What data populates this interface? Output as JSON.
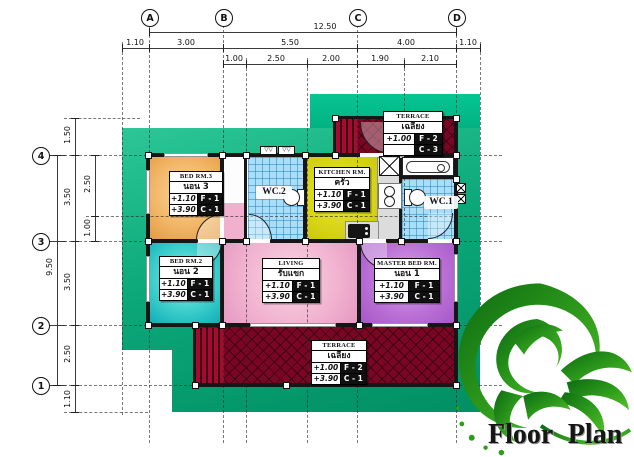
{
  "title": "Floor Plan",
  "grid": {
    "columns": [
      "A",
      "B",
      "C",
      "D"
    ],
    "rows": [
      "4",
      "3",
      "2",
      "1"
    ]
  },
  "dims": {
    "overall_width": "12.50",
    "overall_height": "9.50",
    "top_row1": [
      "1.10",
      "3.00",
      "5.50",
      "4.00",
      "1.10"
    ],
    "top_row2": [
      "1.00",
      "2.50",
      "2.00",
      "1.90",
      "2.10"
    ],
    "left_col1": [
      "1.50",
      "3.50",
      "3.50",
      "2.50",
      "1.10"
    ],
    "left_col2": [
      "2.50",
      "1.00"
    ]
  },
  "rooms": {
    "bed3": {
      "name_en": "BED RM.3",
      "name_th": "นอน 3",
      "floor_level": "+1.10",
      "floor_code": "F - 1",
      "ceiling_level": "+3.90",
      "ceiling_code": "C - 1"
    },
    "bed2": {
      "name_en": "BED RM.2",
      "name_th": "นอน 2",
      "floor_level": "+1.10",
      "floor_code": "F - 1",
      "ceiling_level": "+3.90",
      "ceiling_code": "C - 1"
    },
    "master": {
      "name_en": "MASTER BED RM.",
      "name_th": "นอน 1",
      "floor_level": "+1.10",
      "floor_code": "F - 1",
      "ceiling_level": "+3.90",
      "ceiling_code": "C - 1"
    },
    "living": {
      "name_en": "LIVING",
      "name_th": "รับแขก",
      "floor_level": "+1.10",
      "floor_code": "F - 1",
      "ceiling_level": "+3.90",
      "ceiling_code": "C - 1"
    },
    "kitchen": {
      "name_en": "KITCHEN RM.",
      "name_th": "ครัว",
      "floor_level": "+1.10",
      "floor_code": "F - 1",
      "ceiling_level": "+3.90",
      "ceiling_code": "C - 1"
    },
    "terrace_top": {
      "name_en": "TERRACE",
      "name_th": "เฉลียง",
      "floor_level": "+1.00",
      "floor_code": "F - 2",
      "ceiling_level": "",
      "ceiling_code": "C - 3"
    },
    "terrace_bottom": {
      "name_en": "TERRACE",
      "name_th": "เฉลียง",
      "floor_level": "+1.00",
      "floor_code": "F - 2",
      "ceiling_level": "+3.90",
      "ceiling_code": "C - 1"
    },
    "wc1": {
      "name_en": "WC.1"
    },
    "wc2": {
      "name_en": "WC.2"
    }
  },
  "colors": {
    "ground": "#0ca87a",
    "bed3": "#f2b869",
    "bed2": "#3fd0cd",
    "master": "#bb72d7",
    "living": "#f1b2cf",
    "kitchen": "#d7d416",
    "wc": "#aadef8",
    "terrace": "#7a0624"
  },
  "icons": {
    "ornament": "floral-swirl-icon",
    "fixtures": [
      "bathtub-icon",
      "toilet-icon",
      "washbasin-icon",
      "kitchen-sink-icon",
      "stove-icon",
      "shaft-x-icon",
      "roof-vent-icon"
    ]
  }
}
